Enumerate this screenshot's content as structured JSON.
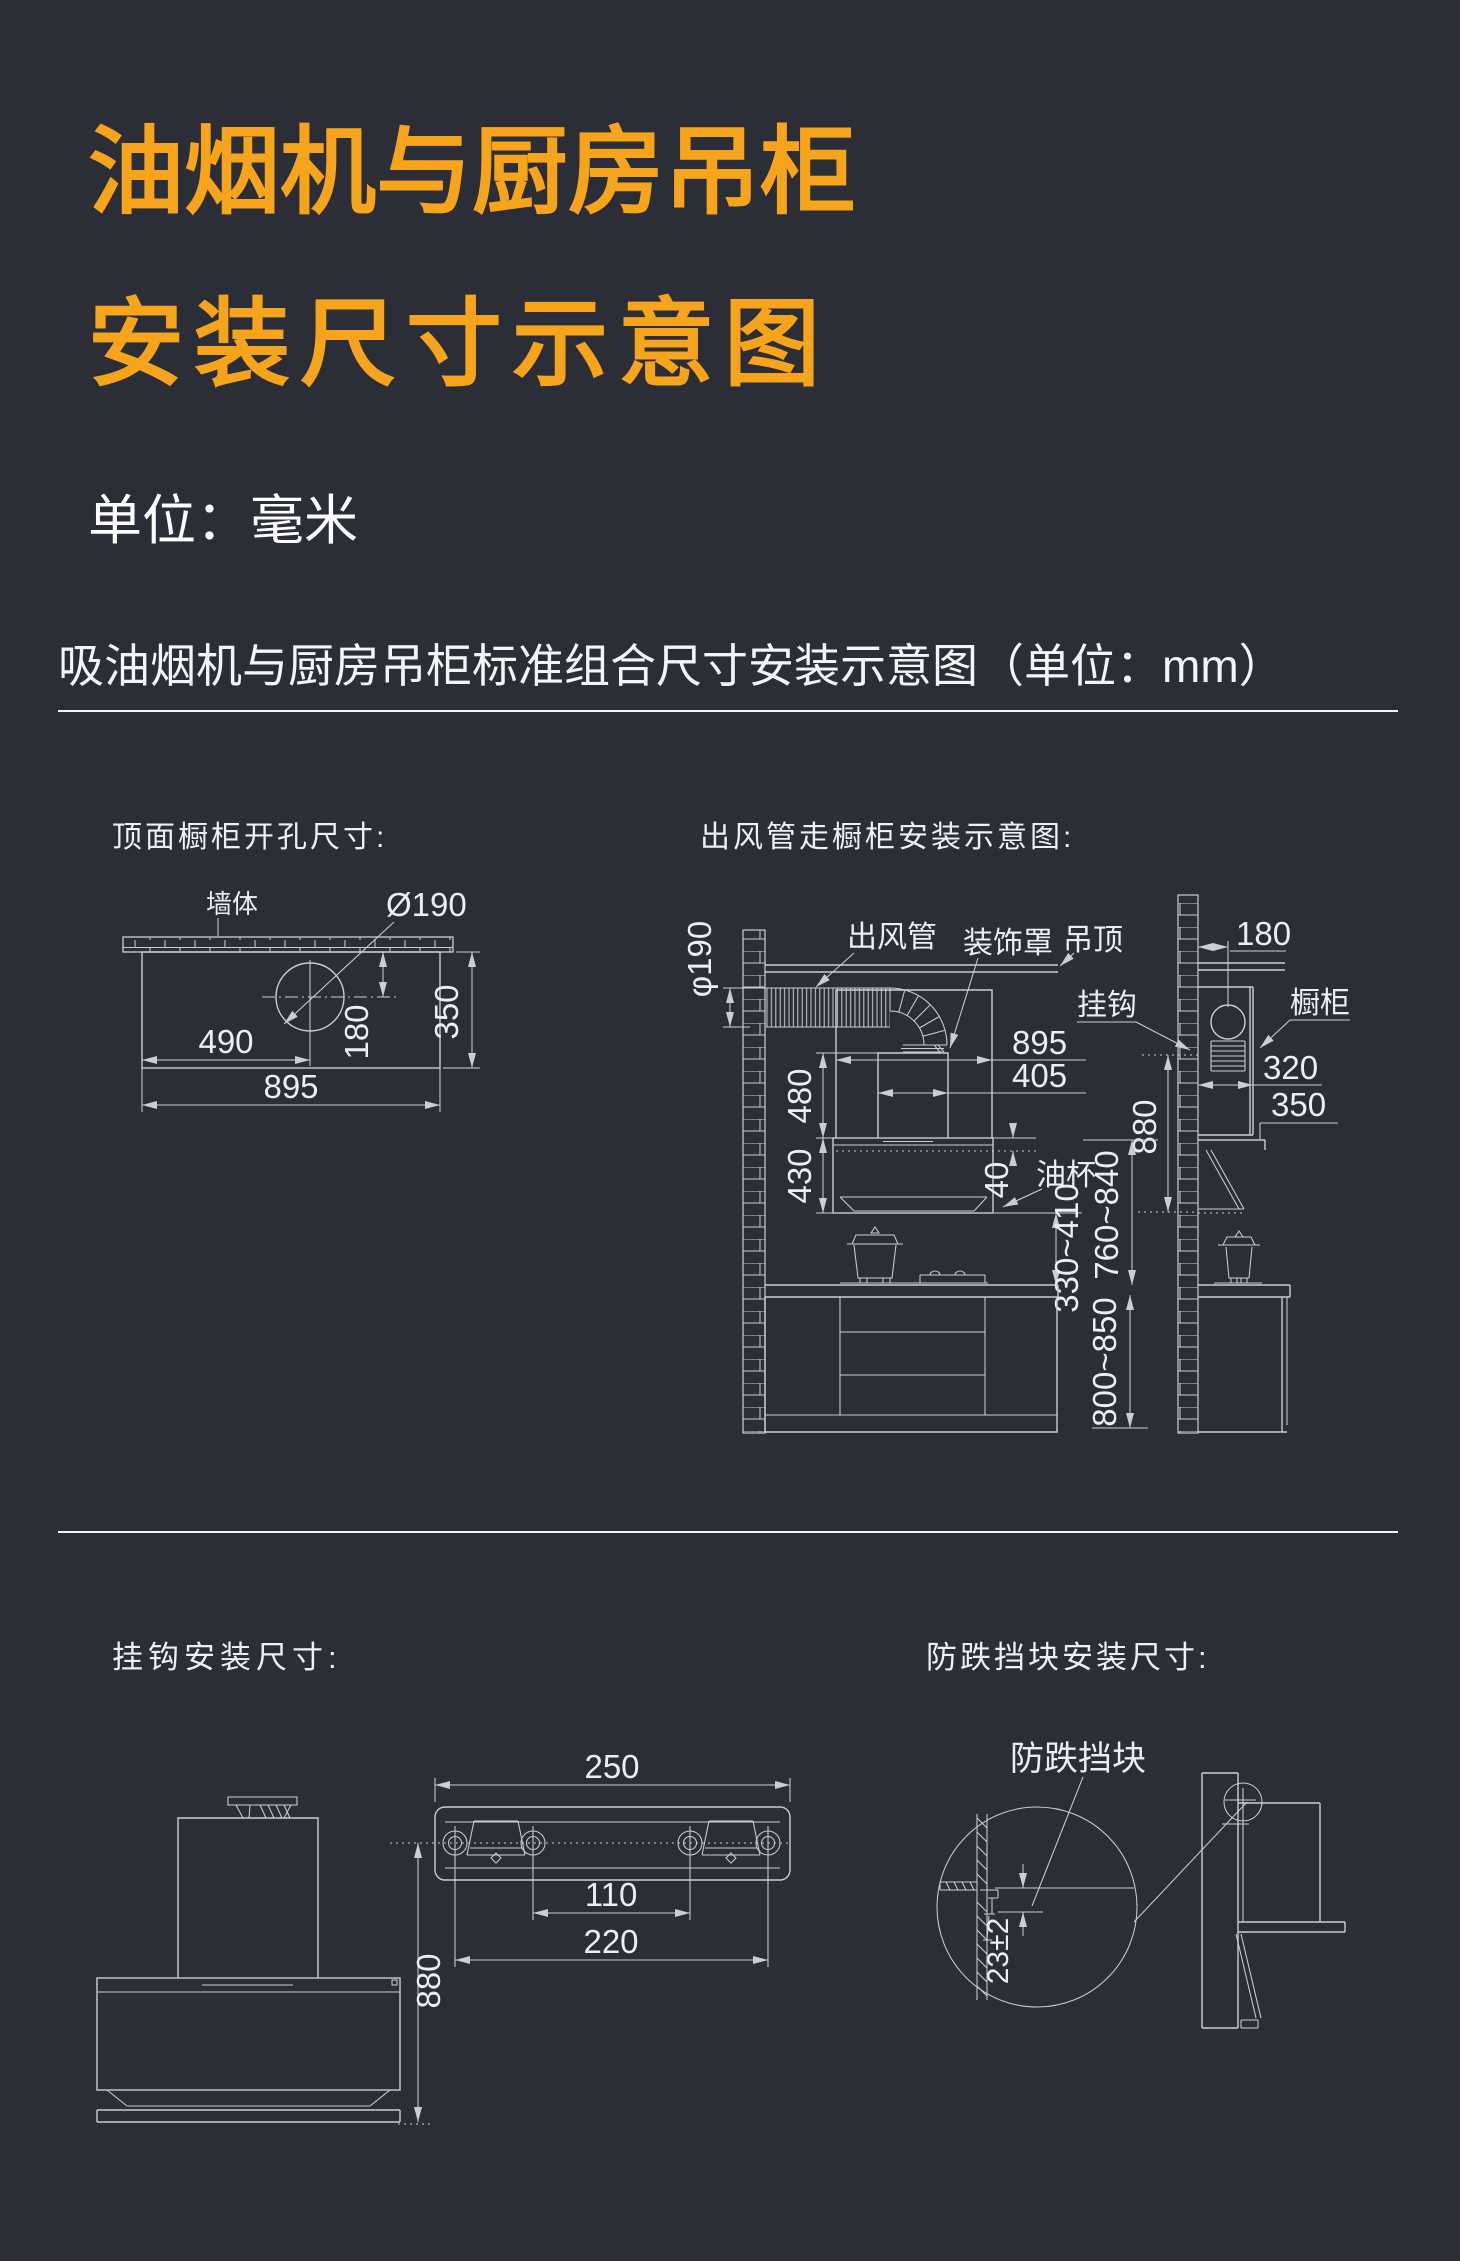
{
  "page": {
    "background": "#2b2d37",
    "accent_orange": "#f7a41d",
    "text_white": "#ffffff",
    "line_gray": "#c9ced6"
  },
  "header": {
    "title_line1": "油烟机与厨房吊柜",
    "title_line2": "安装尺寸示意图",
    "unit_note": "单位：毫米",
    "section_title": "吸油烟机与厨房吊柜标准组合尺寸安装示意图（单位：mm）"
  },
  "cutout": {
    "label": "顶面橱柜开孔尺寸:",
    "wall": "墙体",
    "hole_dia": "Ø190",
    "dim_offset_x": "490",
    "dim_offset_y": "180",
    "dim_depth": "350",
    "dim_width": "895"
  },
  "duct": {
    "label": "出风管走橱柜安装示意图:",
    "duct": "出风管",
    "cover": "装饰罩",
    "ceiling": "吊顶",
    "hook": "挂钩",
    "cabinet": "橱柜",
    "oil_cup": "油杯",
    "dia": "φ190",
    "w895": "895",
    "w405": "405",
    "h480": "480",
    "h430": "430",
    "h40": "40",
    "h880": "880",
    "hook_to_counter": "760~840",
    "hood_to_counter": "330~410",
    "counter_height": "800~850",
    "off180": "180",
    "d320": "320",
    "d350": "350"
  },
  "hook": {
    "label": "挂钩安装尺寸:",
    "w250": "250",
    "w110": "110",
    "w220": "220",
    "h880": "880"
  },
  "block": {
    "label": "防跌挡块安装尺寸:",
    "name": "防跌挡块",
    "gap": "23±2"
  }
}
